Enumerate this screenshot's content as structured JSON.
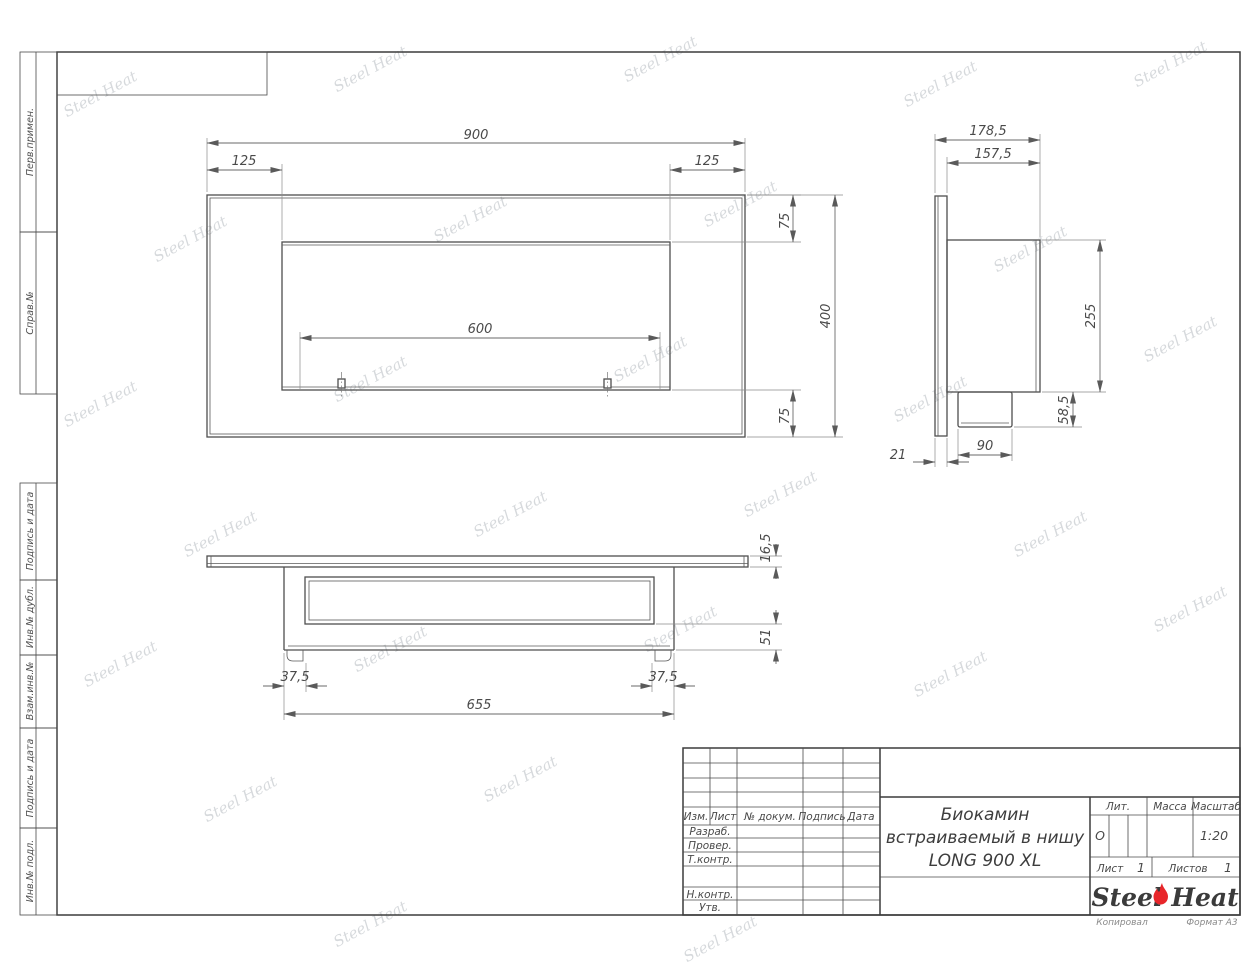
{
  "sheet": {
    "watermark": "Steel Heat",
    "copied_label": "Копировал",
    "format_label": "Формат А3"
  },
  "side_stamps": {
    "items": [
      "Перв.примен.",
      "Справ.№",
      "Подпись и дата",
      "Инв.№ дубл.",
      "Взам.инв.№",
      "Подпись и дата",
      "Инв.№ подл."
    ]
  },
  "title_block": {
    "header_cols": [
      "Изм.",
      "Лист",
      "№ докум.",
      "Подпись",
      "Дата"
    ],
    "sig_labels": [
      "Разраб.",
      "Провер.",
      "Т.контр.",
      "Н.контр.",
      "Утв."
    ],
    "title_lines": [
      "Биокамин",
      "встраиваемый в нишу",
      "LONG 900 XL"
    ],
    "lit_label": "Лит.",
    "lit_value": "О",
    "mass_label": "Масса",
    "scale_label": "Масштаб",
    "scale_value": "1:20",
    "sheet_label": "Лист",
    "sheet_number": "1",
    "sheets_label": "Листов",
    "sheets_total": "1",
    "logo_left": "Steel",
    "logo_right": "Heat"
  },
  "drawing": {
    "front_view": {
      "overall_width": "900",
      "inset_left": "125",
      "inset_right": "125",
      "top_margin": "75",
      "overall_height": "400",
      "burner_length": "600",
      "bottom_margin": "75"
    },
    "side_view": {
      "overall_depth": "178,5",
      "body_depth": "157,5",
      "body_height": "255",
      "burner_height": "58,5",
      "burner_width": "90",
      "flange_thickness": "21"
    },
    "bottom_view": {
      "flange_thickness": "16,5",
      "inner_depth": "51",
      "foot_inset_left": "37,5",
      "foot_inset_right": "37,5",
      "body_width": "655"
    }
  }
}
